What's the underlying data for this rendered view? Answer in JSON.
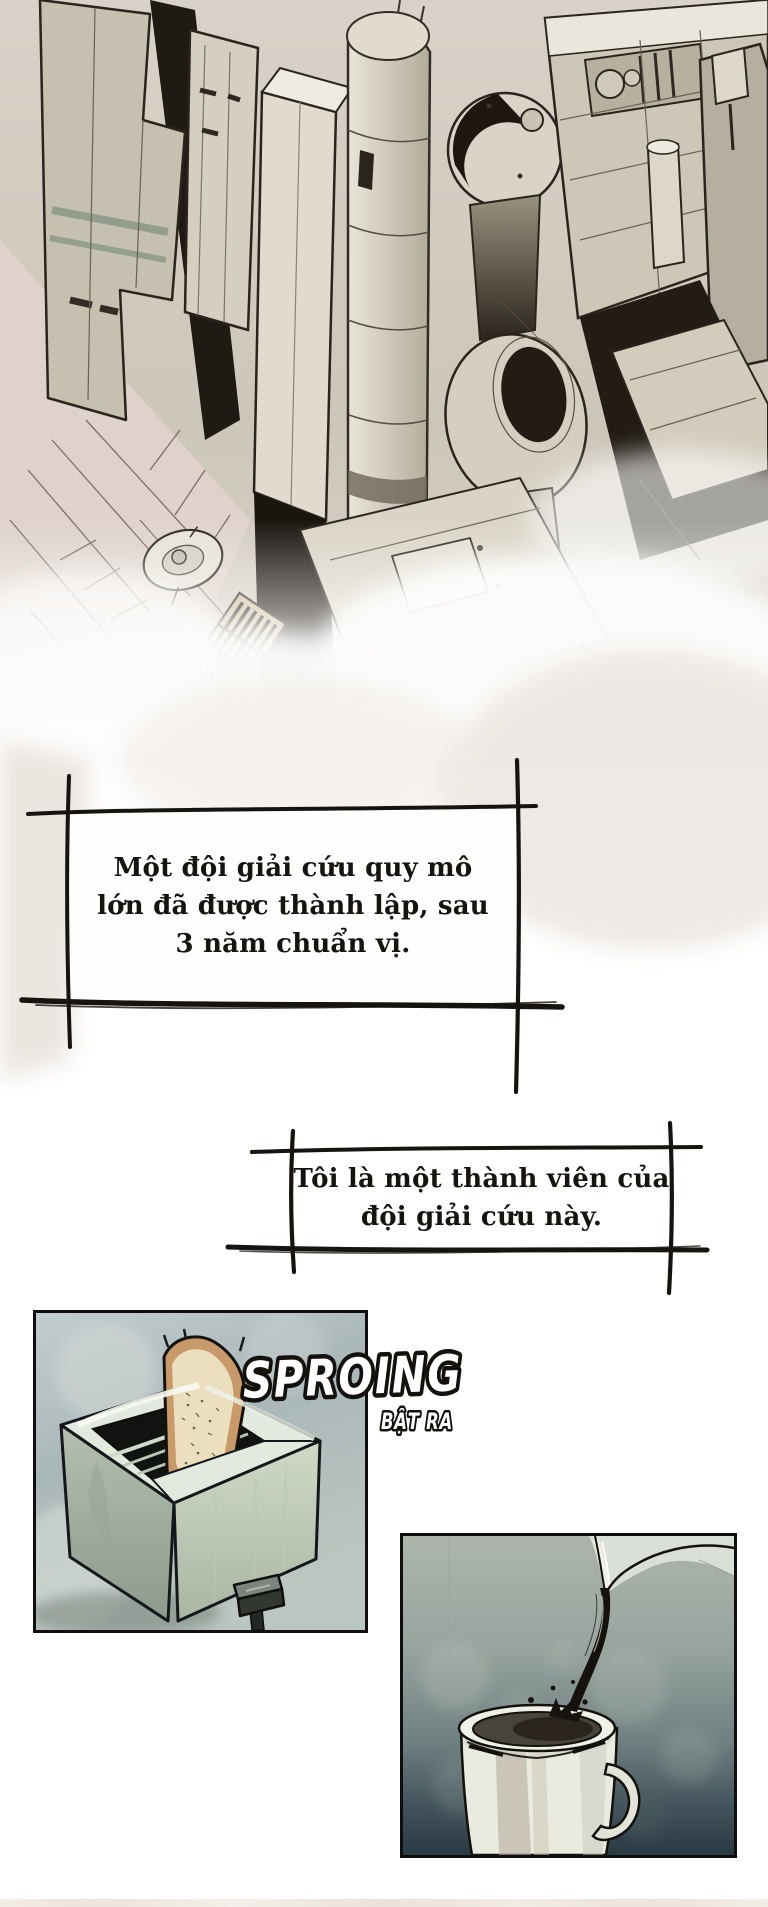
{
  "page": {
    "width_px": 768,
    "height_px": 1907,
    "background_color": "#ffffff",
    "ink_color": "#17130f"
  },
  "narration": {
    "box1": {
      "line1": "Một đội giải cứu quy mô",
      "line2": "lớn đã được thành lập, sau",
      "line3": "3 năm chuẩn vị."
    },
    "box2": {
      "line1": "Tôi là một thành viên của",
      "line2": "đội giải cứu này."
    }
  },
  "sfx": {
    "main": "SPROING",
    "sub": "BẬT RA",
    "fill_color": "#ffffff",
    "outline_color": "#14110d"
  },
  "artwork": {
    "city_panel": {
      "subject": "aerial view of dense sci-fi tower city fading into white clouds",
      "palette": [
        "#d5cfc2",
        "#b6af9f",
        "#e9e5da",
        "#1d1710",
        "#dfd3cb"
      ]
    },
    "toaster_panel": {
      "subject": "slice of toast popping out of a toaster",
      "palette": [
        "#b9c4c4",
        "#dde4da",
        "#c89a6b",
        "#10130f",
        "#99a594"
      ]
    },
    "milk_panel": {
      "subject": "dark liquid pouring from a jug into a mug",
      "palette": [
        "#a9b2aa",
        "#2e3b46",
        "#e9ebe1",
        "#17130e"
      ]
    }
  }
}
